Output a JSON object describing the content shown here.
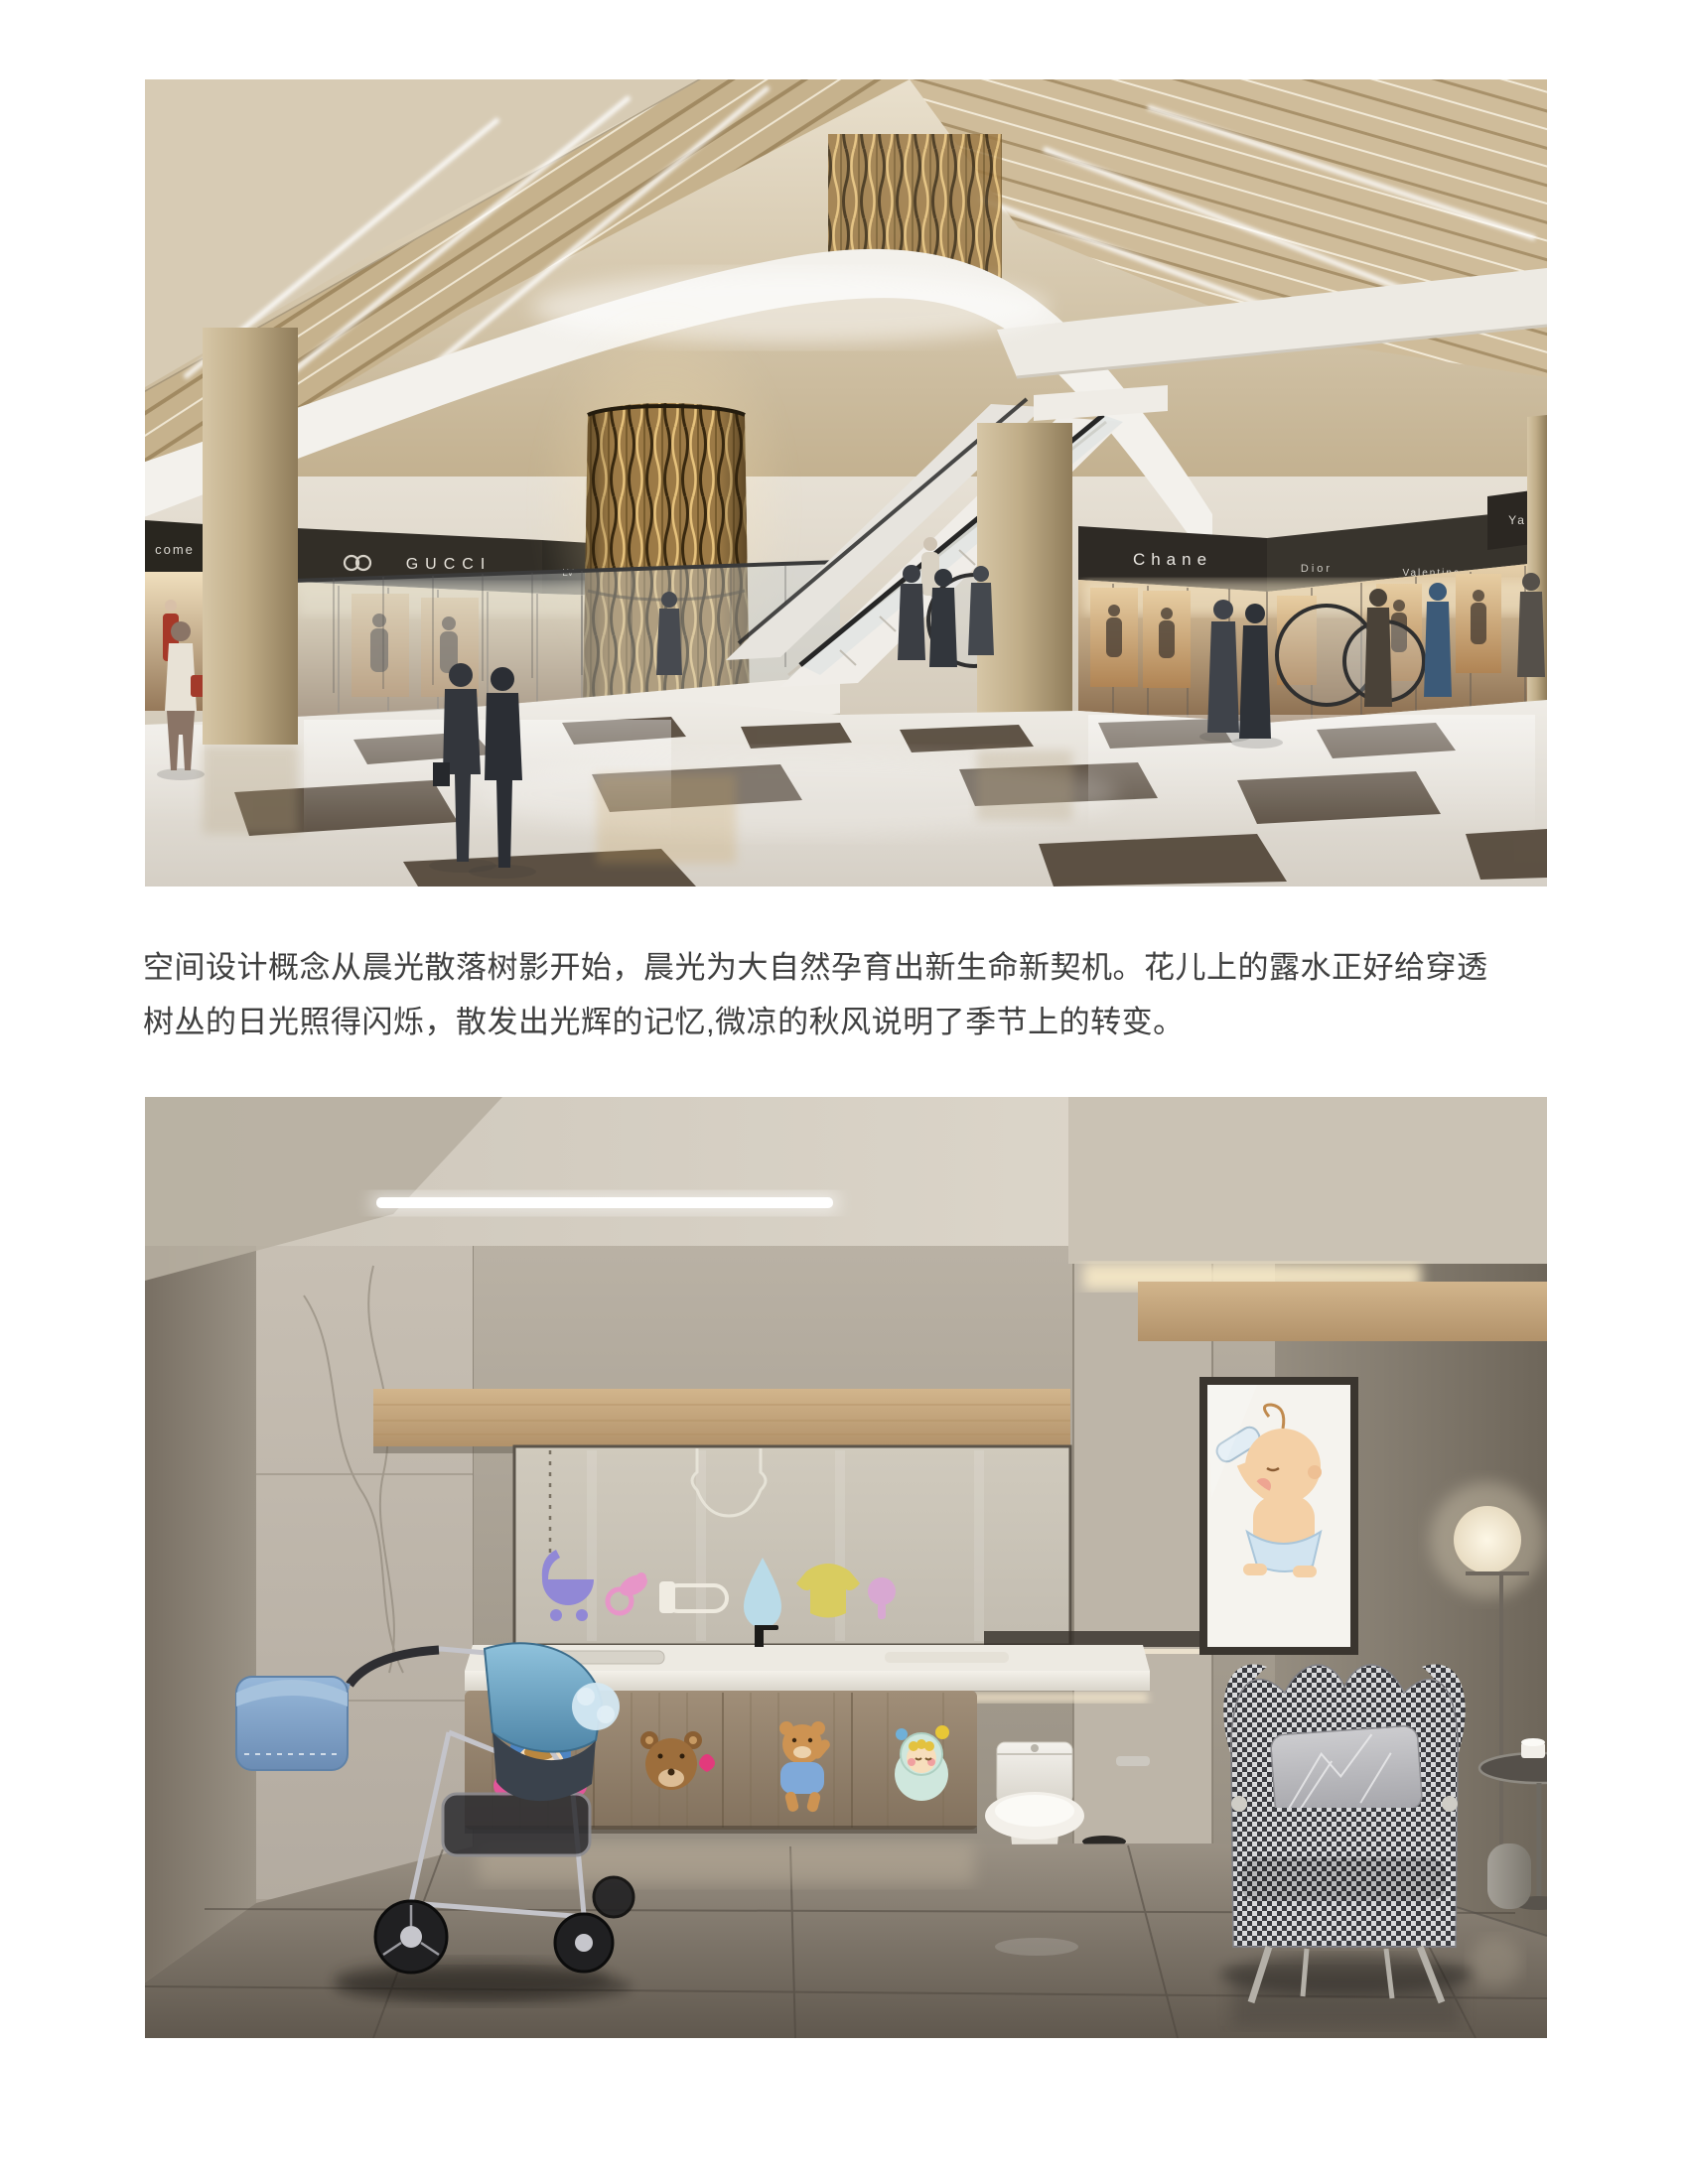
{
  "page": {
    "background": "#ffffff"
  },
  "paragraph": {
    "lines": [
      "空间设计概念从晨光散落树影开始，晨光为大自然孕育出新生命新契机。花儿上的露水正好给穿透",
      "树丛的日光照得闪烁，散发出光辉的记忆,微凉的秋风说明了季节上的转变。"
    ],
    "color": "#3f3f3f"
  },
  "mall_render": {
    "signs": [
      {
        "label": "come"
      },
      {
        "label": "GUCCI"
      },
      {
        "label": "LV"
      },
      {
        "label": "LOUIS"
      },
      {
        "label": "Chane"
      },
      {
        "label": "Dior"
      },
      {
        "label": "Valentine"
      },
      {
        "label": "Ya"
      }
    ],
    "palette": {
      "ceiling_gold": "#c6b28d",
      "bulkhead_white": "#f3f1ec",
      "fascia_dark": "#322e27",
      "column_tan": "#c0ad88",
      "gold_feature_column": "#9c7a46",
      "floor_light": "#e9e5de",
      "floor_inlay": "#473a2c"
    }
  },
  "nursery_render": {
    "panel_icons": [
      "stroller-icon",
      "pacifier-icon",
      "safety-pin-icon",
      "water-drop-icon",
      "onesie-icon",
      "rattle-icon"
    ],
    "cabinet_decals": [
      "bear-girl-decal",
      "teddy-face-decal",
      "dancing-bear-decal",
      "baby-bunting-decal"
    ],
    "palette": {
      "wall_marble": "#b6aea1",
      "wood_band": "#c5a67c",
      "counter_white": "#edeae2",
      "cabinet_wood": "#9e8c76",
      "floor_dark": "#6f655a",
      "stroller_canopy_blue": "#7fb6d4",
      "houndstooth_dark": "#3a3b40",
      "cove_light": "#f7e9c7"
    }
  }
}
